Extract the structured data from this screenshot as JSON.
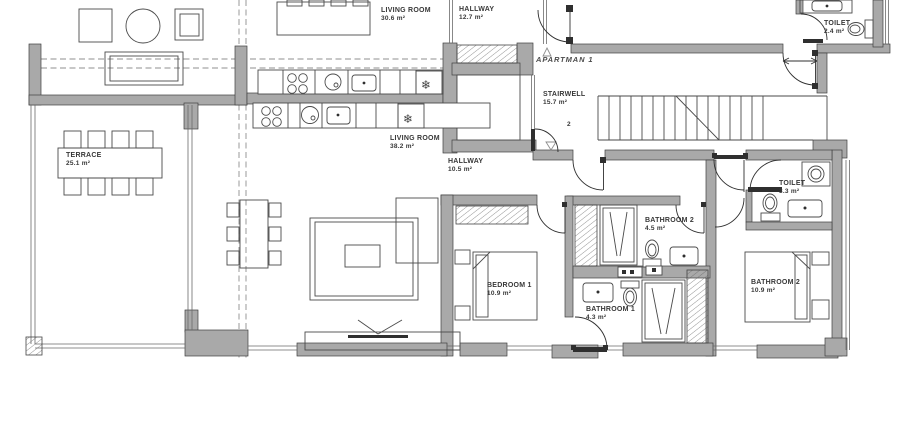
{
  "plan": {
    "apartment_label": "APARTMAN 1",
    "level_number": "2"
  },
  "icons": {
    "fridge_glyph": "❄"
  },
  "colors": {
    "wall_fill": "#a9a9a9",
    "outline": "#3f3f3f",
    "furniture_line": "#4a4a4a",
    "dashed_line": "#8f8f8f",
    "label_text": "#383838",
    "background": "#ffffff"
  },
  "rooms": {
    "living_room_upper": {
      "name": "LIVING ROOM",
      "area": "30.6 m²"
    },
    "hallway_upper": {
      "name": "HALLWAY",
      "area": "12.7 m²"
    },
    "toilet_upper": {
      "name": "TOILET",
      "area": "2.4 m²"
    },
    "stairwell": {
      "name": "STAIRWELL",
      "area": "15.7 m²"
    },
    "terrace": {
      "name": "TERRACE",
      "area": "25.1 m²"
    },
    "living_room_lower": {
      "name": "LIVING ROOM",
      "area": "38.2 m²"
    },
    "hallway_lower": {
      "name": "HALLWAY",
      "area": "10.5 m²"
    },
    "bedroom_1": {
      "name": "BEDROOM 1",
      "area": "10.9 m²"
    },
    "bathroom_2": {
      "name": "BATHROOM 2",
      "area": "4.5 m²"
    },
    "bathroom_1": {
      "name": "BATHROOM 1",
      "area": "4.3 m²"
    },
    "toilet_right": {
      "name": "TOILET",
      "area": "3.3 m²"
    },
    "bedroom_2": {
      "name": "BATHROOM 2",
      "area": "10.9 m²"
    }
  }
}
